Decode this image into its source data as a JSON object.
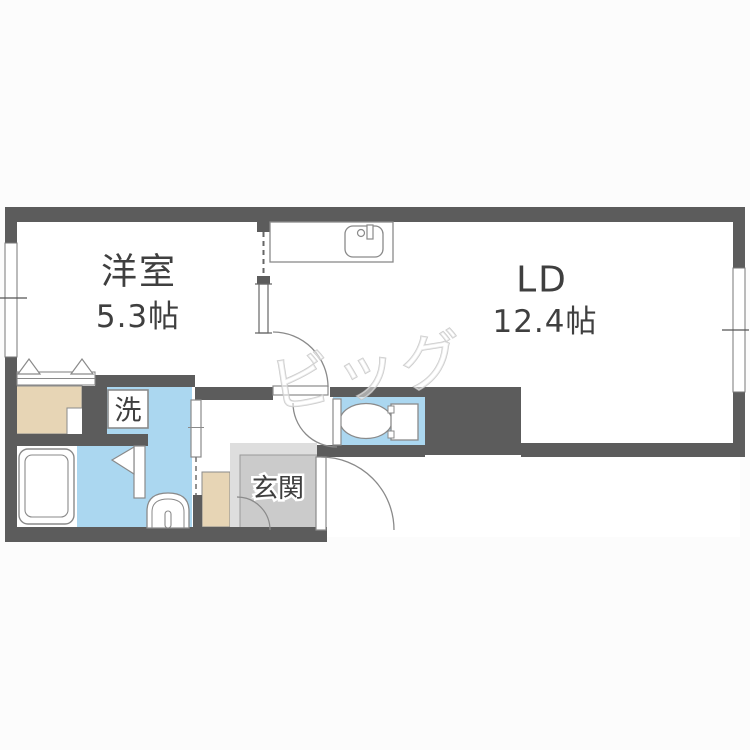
{
  "floor_plan": {
    "rooms": {
      "western_room": {
        "name": "洋室",
        "size": "5.3帖"
      },
      "living_dining": {
        "name": "LD",
        "size": "12.4帖"
      },
      "entrance": {
        "label": "玄関"
      },
      "laundry_box": {
        "label": "洗"
      }
    },
    "watermark": {
      "text": "ビッグ"
    },
    "colors": {
      "wall": "#5c5c5c",
      "wet_area_blue": "#abd7f0",
      "closet_beige": "#e7d5b5",
      "entrance_gray": "#cbcbcb",
      "entrance_step_gray": "#dedede",
      "fixture_line": "#7b7b7b",
      "label_text": "#3f3f3f"
    },
    "fixtures": [
      "kitchen-sink",
      "bathtub",
      "washing-machine-pan",
      "vanity",
      "washbasin",
      "toilet",
      "closet-folding-door",
      "left-window",
      "right-window",
      "ld-door",
      "toilet-door",
      "front-door",
      "washroom-sliding-door"
    ]
  }
}
